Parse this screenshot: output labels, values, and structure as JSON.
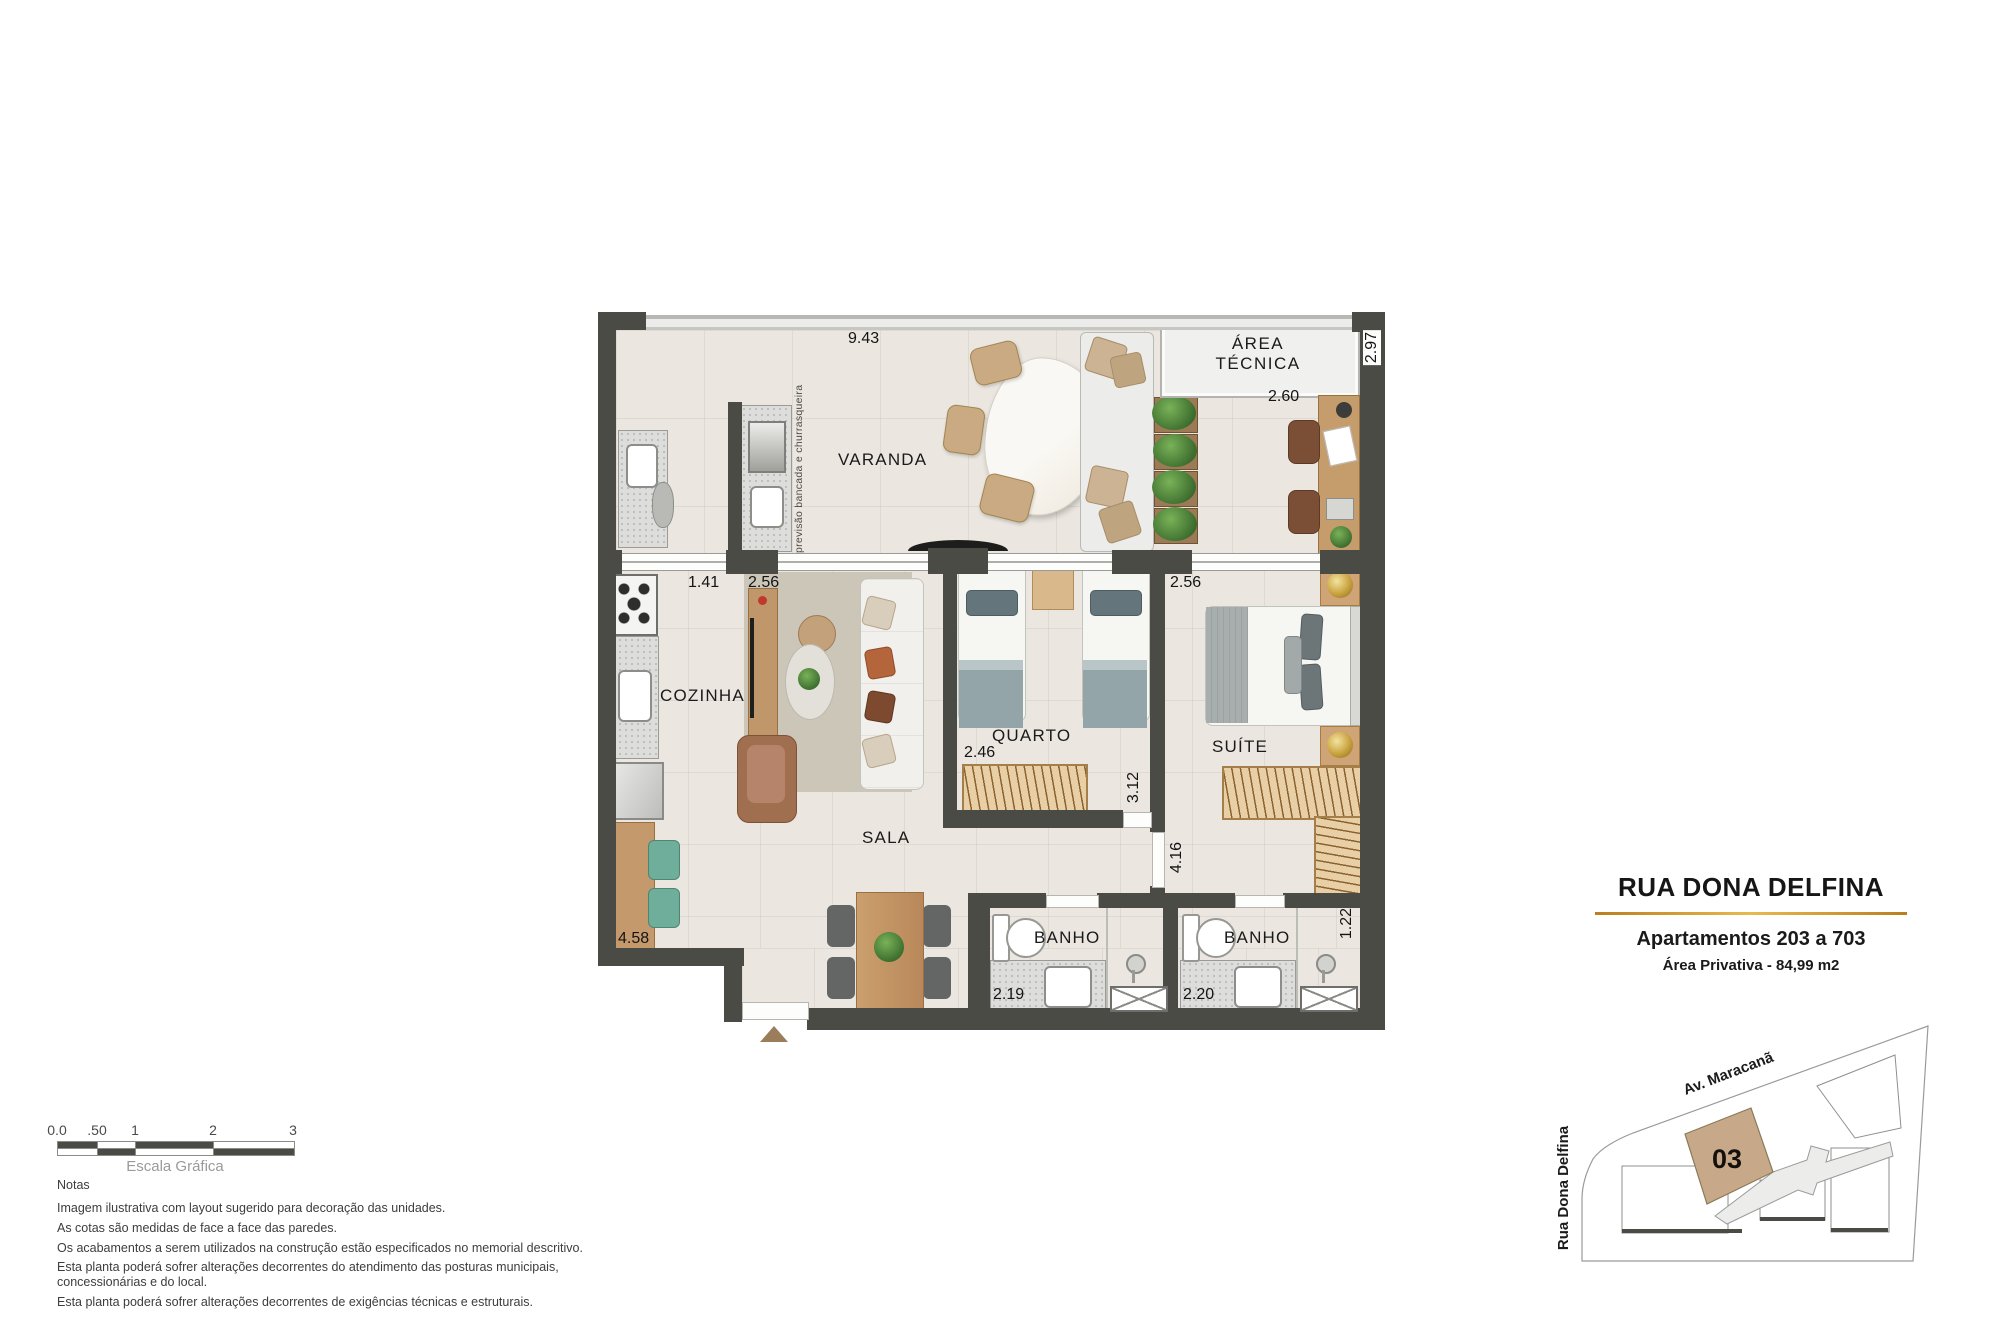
{
  "plan": {
    "rooms": {
      "varanda": "VARANDA",
      "area_tecnica_line1": "ÁREA",
      "area_tecnica_line2": "TÉCNICA",
      "cozinha": "COZINHA",
      "sala": "SALA",
      "quarto": "QUARTO",
      "suite": "SUÍTE",
      "banho_social": "BANHO",
      "banho_suite": "BANHO"
    },
    "annotations": {
      "bancada": "previsão bancada e churrasqueira"
    },
    "dimensions": {
      "varanda_width": "9.43",
      "varanda_depth": "2.97",
      "desk_width": "2.60",
      "kitchen_pass": "1.41",
      "sala_width": "2.56",
      "suite_width": "2.56",
      "closet_width": "2.46",
      "quarto_depth": "3.12",
      "suite_depth": "4.16",
      "cozinha_length": "4.58",
      "banho_social_width": "2.19",
      "banho_suite_width": "2.20",
      "banho_suite_depth": "1.22"
    }
  },
  "title_block": {
    "street": "RUA DONA DELFINA",
    "apartments": "Apartamentos 203 a 703",
    "private_area": "Área Privativa - 84,99 m2",
    "underline_color": "#d9a12f"
  },
  "site_map": {
    "street_diagonal": "Av. Maracanã",
    "street_vertical": "Rua Dona Delfina",
    "unit_number": "03",
    "unit_fill": "#c7a98a"
  },
  "scale_bar": {
    "ticks": [
      "0.0",
      ".50",
      "1",
      "2",
      "3"
    ],
    "caption": "Escala Gráfica"
  },
  "notes": {
    "heading": "Notas",
    "lines": [
      "Imagem ilustrativa com layout sugerido para decoração das unidades.",
      "As cotas são medidas de face a face das paredes.",
      "Os acabamentos a serem utilizados na construção estão especificados no memorial descritivo.",
      "Esta planta poderá sofrer alterações decorrentes do atendimento das posturas municipais, concessionárias e do local.",
      "Esta planta poderá sofrer alterações decorrentes de exigências técnicas e estruturais."
    ]
  }
}
